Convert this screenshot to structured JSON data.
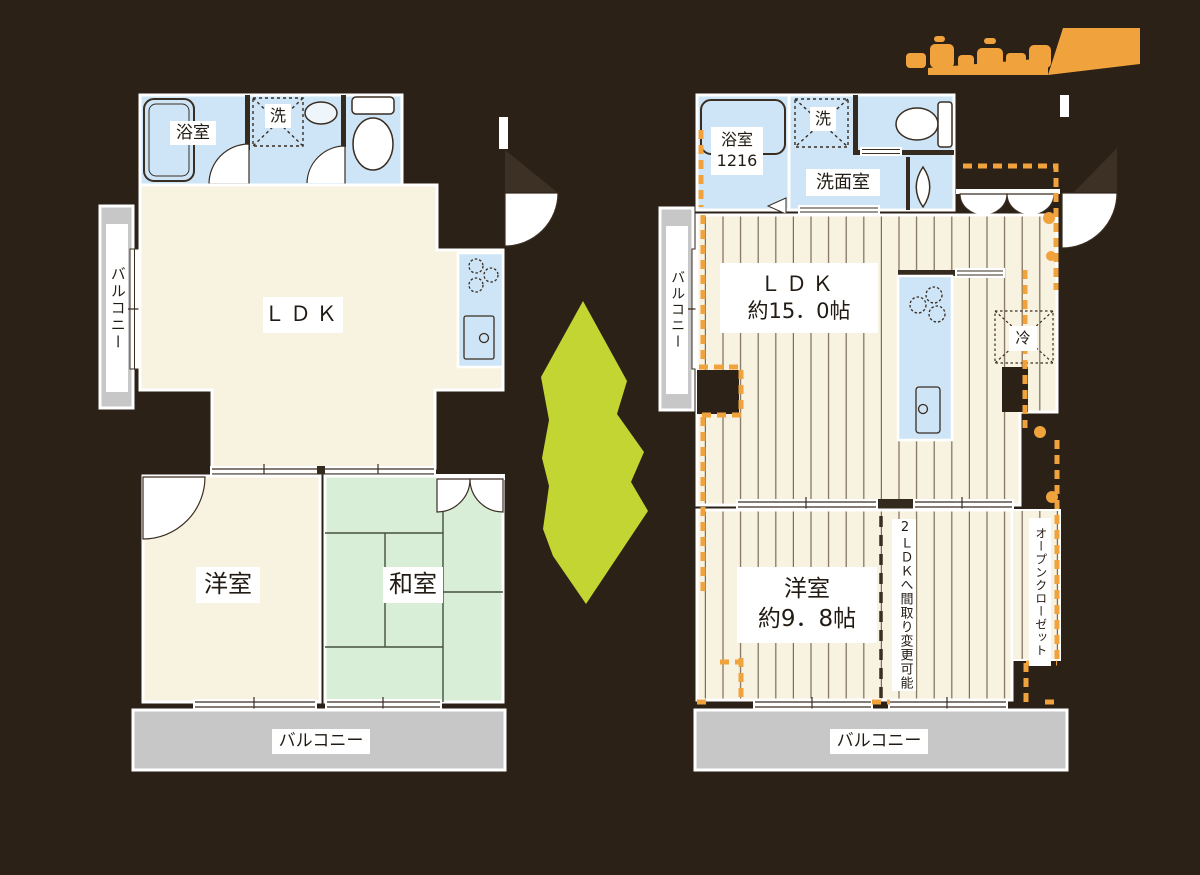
{
  "left_plan": {
    "balcony_side_label": "バルコニー",
    "bath_label": "浴室",
    "washer_label": "洗",
    "ldk_label": "ＬＤＫ",
    "western_room_label": "洋室",
    "japanese_room_label": "和室",
    "balcony_bottom_label": "バルコニー"
  },
  "right_plan": {
    "balcony_side_label": "バルコニー",
    "bath_label": "浴室",
    "bath_size": "1216",
    "washer_label": "洗",
    "washroom_label": "洗面室",
    "ldk_label": "ＬＤＫ",
    "ldk_size": "約15．0帖",
    "fridge_label": "冷",
    "western_room_label": "洋室",
    "western_room_size": "約9．8帖",
    "layout_note": "2ＬＤＫへ間取り変更可能",
    "open_closet_label": "オープンクローゼット",
    "balcony_bottom_label": "バルコニー"
  },
  "colors": {
    "background": "#2b2117",
    "floor_cream": "#f8f2e0",
    "wet_area_blue": "#cde5f6",
    "tatami_green": "#d9eed6",
    "balcony_gray": "#c7c7c8",
    "renovation_orange": "#f0a23c",
    "arrow_green": "#c3d532"
  }
}
